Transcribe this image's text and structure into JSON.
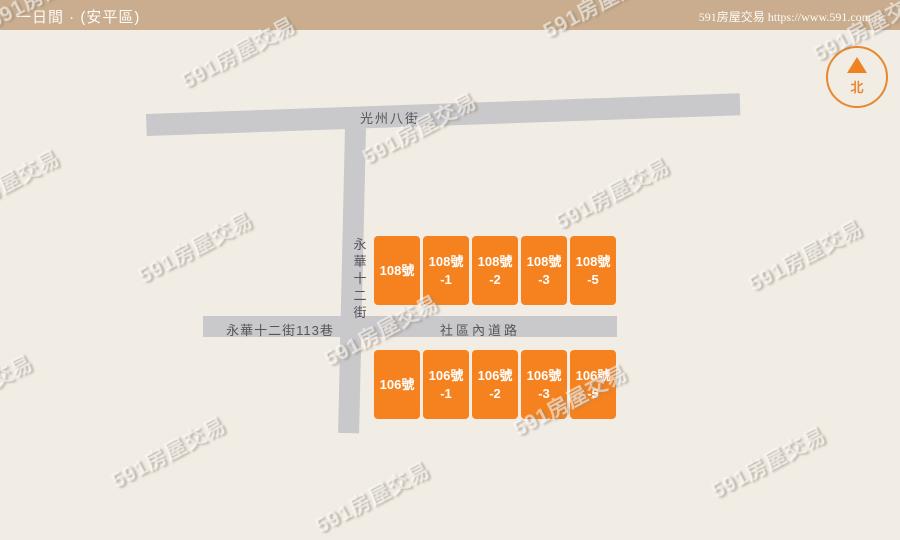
{
  "header": {
    "title": "一日間 · (安平區)",
    "source": "591房屋交易 https://www.591.com.tw"
  },
  "compass": {
    "north_label": "北"
  },
  "watermark": {
    "text": "591房屋交易"
  },
  "map": {
    "roads": {
      "top": {
        "name": "光州八街"
      },
      "vertical": {
        "name": "永華十二街"
      },
      "lane_left": {
        "name": "永華十二街113巷"
      },
      "lane_right": {
        "name": "社區內道路"
      }
    },
    "buildings": {
      "top_row": [
        {
          "line1": "108號",
          "line2": ""
        },
        {
          "line1": "108號",
          "line2": "-1"
        },
        {
          "line1": "108號",
          "line2": "-2"
        },
        {
          "line1": "108號",
          "line2": "-3"
        },
        {
          "line1": "108號",
          "line2": "-5"
        }
      ],
      "bottom_row": [
        {
          "line1": "106號",
          "line2": ""
        },
        {
          "line1": "106號",
          "line2": "-1"
        },
        {
          "line1": "106號",
          "line2": "-2"
        },
        {
          "line1": "106號",
          "line2": "-3"
        },
        {
          "line1": "106號",
          "line2": "-5"
        }
      ]
    }
  },
  "colors": {
    "header_bg": "#C9AD8E",
    "background": "#F1ECE4",
    "road": "#C9C8CB",
    "building": "#F5821E",
    "accent_orange": "#E8872B",
    "road_text": "#55565A"
  }
}
